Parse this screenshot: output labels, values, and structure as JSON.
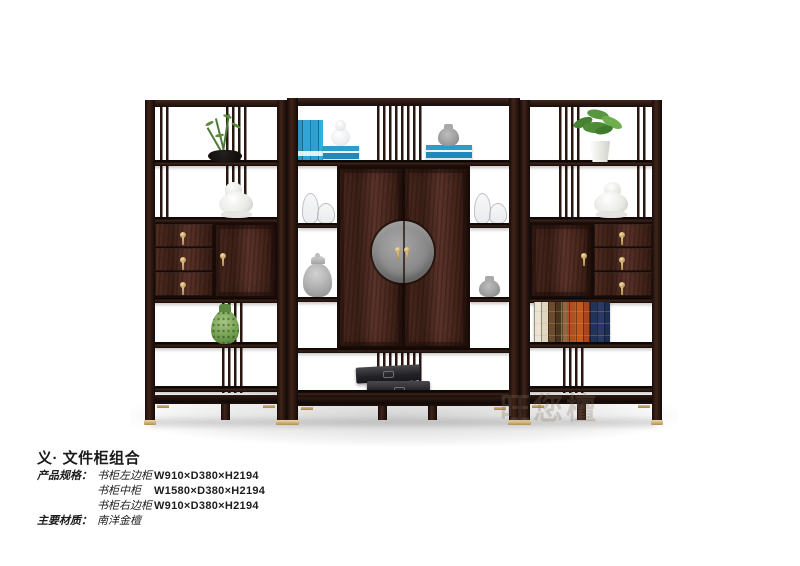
{
  "product": {
    "title": "义· 文件柜组合",
    "specs_label": "产品规格：",
    "specs": [
      {
        "name": "书柜左边柜",
        "size": "W910×D380×H2194"
      },
      {
        "name": "书柜中柜",
        "size": "W1580×D380×H2194"
      },
      {
        "name": "书柜右边柜",
        "size": "W910×D380×H2194"
      }
    ],
    "material_label": "主要材质：",
    "material_value": "南洋金檀",
    "watermark": "旺您檀"
  },
  "photo": {
    "subject": "three-piece dark-wood display / file cabinet combination",
    "decor_items": [
      "potted-plant-black-bowl",
      "white-lion-statue",
      "drawer-brass-pulls",
      "green-porcelain-jar",
      "blue-books",
      "white-gourd-vase",
      "gray-jar",
      "glass-gourd-jars",
      "gray-ginger-jar",
      "round-gray-medallion",
      "black-lacquer-boxes",
      "leather-bound-books",
      "potted-plant-white-pot"
    ],
    "colors": {
      "background": "#ffffff",
      "wood_dark": "#2a1712",
      "wood_face": "#4a2a20",
      "brass": "#d2b176",
      "medallion_gray": "#8a8a8a",
      "book_blue": "#2e9cc9"
    }
  }
}
